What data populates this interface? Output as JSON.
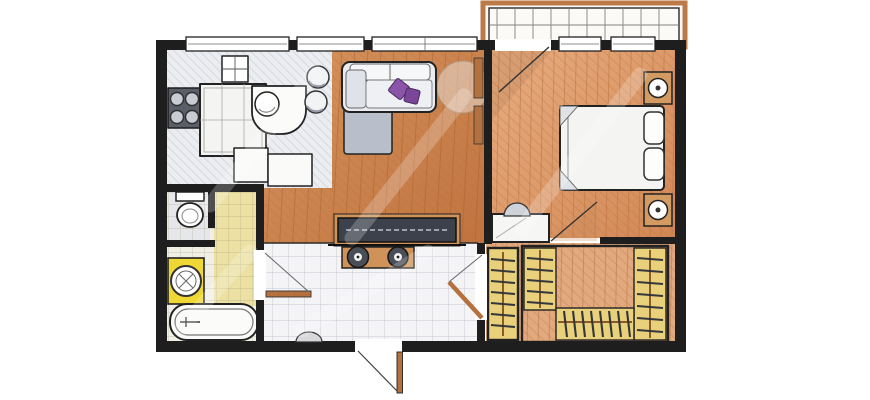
{
  "plan": {
    "kind": "apartment-floor-plan-sketch",
    "rooms": [
      "kitchen",
      "living-room",
      "bedroom",
      "bathroom",
      "wc",
      "hallway",
      "dressing-room",
      "balcony"
    ],
    "furniture": [
      "stove",
      "wall-cabinet",
      "kitchen-island",
      "bar-counter",
      "sink",
      "bar-stools",
      "corner-sofa",
      "throw-pillows",
      "floor-lamp",
      "tv-console",
      "media-bench",
      "toilet",
      "washing-machine",
      "bathtub",
      "double-bed",
      "bed-pillows",
      "nightstand",
      "table-lamp",
      "vanity-niche",
      "wardrobe-hangers",
      "balcony-deck",
      "entrance-door",
      "door-mat"
    ]
  },
  "colors": {
    "background": "#ffffff",
    "wall": "#1e1e1e",
    "kitchen_floor": "#ebedf1",
    "wood_living": "#d6945e",
    "wood_living_deep": "#c1733f",
    "wood_bedroom": "#e8ad80",
    "wood_bedroom_deep": "#d28755",
    "hallway_floor": "#f4f4f7",
    "bathroom_floor": "#f0efe6",
    "bathroom_tile_yellow": "#ece09c",
    "wc_floor": "#e5e7ea",
    "dressing_floor": "#e2a97e",
    "closet_floor": "#e9d07b",
    "washer_yellow": "#efd835",
    "fixture_white": "#fbfbf9",
    "sofa_body": "#e9ebef",
    "sofa_chaise": "#b9bfca",
    "pillow_a": "#8a55a8",
    "pillow_b": "#7a4698",
    "tv_screen": "#3c414b",
    "bench_wood": "#cf9359",
    "stove_dark": "#5a5e66",
    "nightstand_wood": "#d39a62",
    "door_wood": "#b5713d",
    "balcony_frame": "#bd7a49",
    "speaker_dark": "#4a4e57"
  }
}
